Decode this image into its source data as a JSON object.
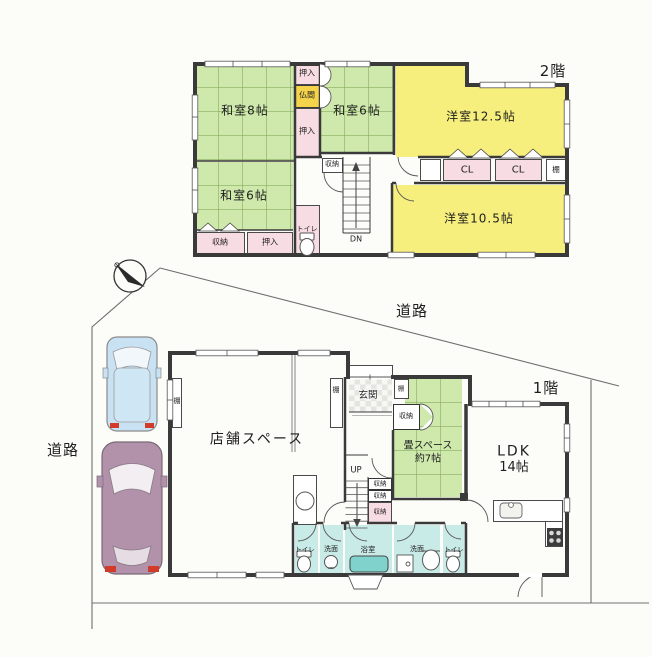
{
  "title_labels": {
    "floor2": "2階",
    "floor1": "1階"
  },
  "site": {
    "road_left": "道路",
    "road_top": "道路",
    "compass": "compass-needle-northwest"
  },
  "second_floor": {
    "rooms": {
      "washitsu8": "和室8帖",
      "washitsu6_top": "和室6帖",
      "yoshitsu125": "洋室12.5帖",
      "washitsu6_left": "和室6帖",
      "yoshitsu105": "洋室10.5帖"
    },
    "closets": {
      "oshiire_top": "押入",
      "butsuma": "仏間",
      "oshiire_mid": "押入",
      "shuno_stair": "収納",
      "cl_left": "CL",
      "cl_right": "CL",
      "tana": "棚",
      "shuno_bottom": "収納",
      "oshiire_bottom": "押入"
    },
    "fixtures": {
      "toilet": "トイレ",
      "stairs_down": "DN"
    }
  },
  "first_floor": {
    "rooms": {
      "shop": "店舗スペース",
      "genkan": "玄関",
      "tatami_name": "畳スペース",
      "tatami_size": "約7帖",
      "ldk_name": "LDK",
      "ldk_size": "14帖",
      "bath": "浴室"
    },
    "closets": {
      "tana_shop_left": "棚",
      "tana_shop_right": "棚",
      "tana_entry": "棚",
      "shuno_entry": "収納",
      "shuno_stack_1": "収納",
      "shuno_stack_2": "収納",
      "shuno_stack_3": "収納"
    },
    "fixtures": {
      "stairs_up": "UP",
      "toilet_left": "トイレ",
      "senmen_left": "洗面",
      "senmen_right": "洗面",
      "toilet_right": "トイレ"
    }
  },
  "colors": {
    "tatami_green": "#cfe9ac",
    "western_yellow": "#f7ef7d",
    "closet_pink": "#f8dce3",
    "butsuma_gold": "#f5d44c",
    "bath_cyan": "#c9ebe8",
    "tub_teal": "#7fd3cc",
    "wall": "#3a3a3a",
    "car_blue": "#c9e2f3",
    "car_purple": "#b192aa",
    "taillight_red": "#d23a2a"
  }
}
